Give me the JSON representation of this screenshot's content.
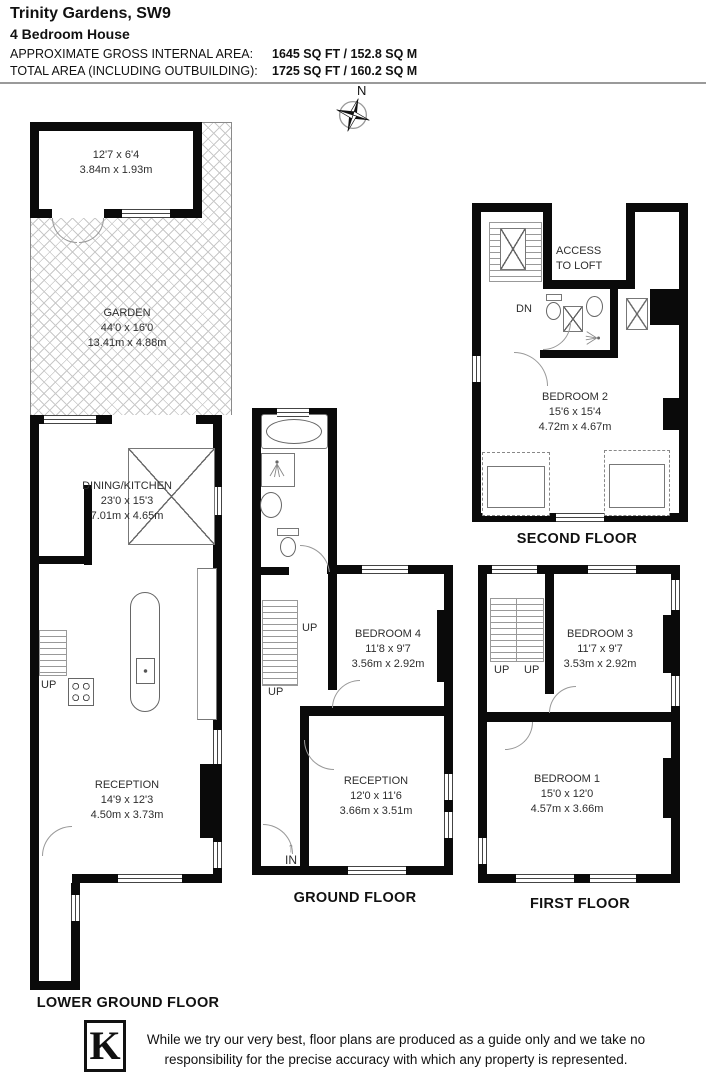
{
  "header": {
    "title": "Trinity Gardens, SW9",
    "subtitle": "4 Bedroom House",
    "area_line1_label": "APPROXIMATE GROSS INTERNAL AREA:",
    "area_line1_value": "1645 SQ FT / 152.8 SQ M",
    "area_line2_label": "TOTAL AREA (INCLUDING OUTBUILDING):",
    "area_line2_value": "1725 SQ FT / 160.2 SQ M"
  },
  "compass": {
    "north_label": "N"
  },
  "floors": {
    "lower_ground": {
      "label": "LOWER GROUND FLOOR",
      "rooms": {
        "outbuilding": {
          "dims_imperial": "12'7 x 6'4",
          "dims_metric": "3.84m x 1.93m"
        },
        "garden": {
          "name": "GARDEN",
          "dims_imperial": "44'0 x 16'0",
          "dims_metric": "13.41m x 4.88m"
        },
        "dining_kitchen": {
          "name": "DINING/KITCHEN",
          "dims_imperial": "23'0 x 15'3",
          "dims_metric": "7.01m x 4.65m"
        },
        "reception": {
          "name": "RECEPTION",
          "dims_imperial": "14'9 x 12'3",
          "dims_metric": "4.50m x 3.73m"
        }
      },
      "annotations": {
        "up": "UP"
      }
    },
    "ground": {
      "label": "GROUND FLOOR",
      "rooms": {
        "bedroom4": {
          "name": "BEDROOM 4",
          "dims_imperial": "11'8 x 9'7",
          "dims_metric": "3.56m x 2.92m"
        },
        "reception": {
          "name": "RECEPTION",
          "dims_imperial": "12'0 x 11'6",
          "dims_metric": "3.66m x 3.51m"
        }
      },
      "annotations": {
        "up1": "UP",
        "up2": "UP",
        "in": "IN",
        "in_arrow": "↑"
      }
    },
    "first": {
      "label": "FIRST FLOOR",
      "rooms": {
        "bedroom3": {
          "name": "BEDROOM 3",
          "dims_imperial": "11'7 x 9'7",
          "dims_metric": "3.53m x 2.92m"
        },
        "bedroom1": {
          "name": "BEDROOM 1",
          "dims_imperial": "15'0 x 12'0",
          "dims_metric": "4.57m x 3.66m"
        }
      },
      "annotations": {
        "up1": "UP",
        "up2": "UP"
      }
    },
    "second": {
      "label": "SECOND FLOOR",
      "rooms": {
        "bedroom2": {
          "name": "BEDROOM 2",
          "dims_imperial": "15'6 x 15'4",
          "dims_metric": "4.72m x 4.67m"
        }
      },
      "annotations": {
        "access_line1": "ACCESS",
        "access_line2": "TO LOFT",
        "dn": "DN"
      }
    }
  },
  "footer": {
    "logo_letter": "K",
    "disclaimer_line1": "While we try our very best, floor plans are produced as a guide only and we take no",
    "disclaimer_line2": "responsibility for the precise accuracy with which any property is represented."
  },
  "colors": {
    "wall": "#0a0a0a",
    "hatch_line": "#c9c9c9",
    "room_label_text": "#2e2e2e"
  }
}
